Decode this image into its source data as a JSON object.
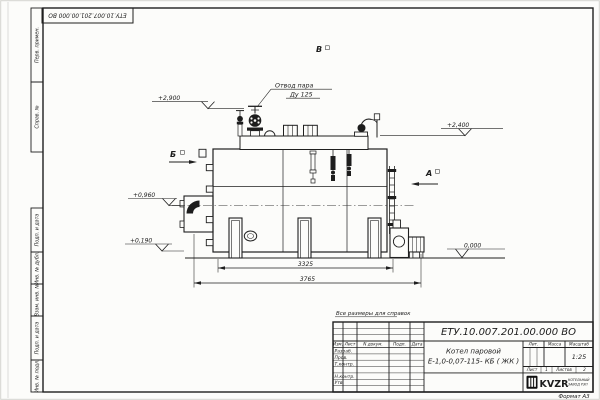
{
  "sheet": {
    "doc_number_top": "ЕТУ.10.007.201.00.000 ВО",
    "format_label": "Формат А3",
    "side_labels_top": [
      "Перв. примен.",
      "Справ. №"
    ],
    "side_labels_bottom": [
      "Подп. и дата",
      "Инв. № дубл.",
      "Взам. инв. №",
      "Подп. и дата",
      "Инв. № подл."
    ]
  },
  "drawing": {
    "note": "Все размеры для справок",
    "steam_outlet": {
      "line1": "Отвод пара",
      "line2": "Ду 125"
    },
    "views": {
      "top": "В",
      "left": "Б",
      "right": "А"
    },
    "elevations": {
      "valve_top": "+2,900",
      "shell_top": "+2,400",
      "burner_axis": "+0,960",
      "lower_port": "+0,190",
      "ground": "0,000"
    },
    "dimensions": {
      "between_supports": "3325",
      "overall_length": "3765"
    }
  },
  "title_block": {
    "doc_number": "ЕТУ.10.007.201.00.000 ВО",
    "product_line1": "Котел паровой",
    "product_line2": "Е-1,0-0,07-115- КБ ( ЖК )",
    "columns": {
      "izm": "Изм.",
      "list": "Лист",
      "ndoc": "N докум.",
      "podp": "Подп.",
      "data": "Дата"
    },
    "rows": [
      "Разраб.",
      "Пров.",
      "Т.контр.",
      "Н.контр.",
      "Утв."
    ],
    "lit_label": "Лит.",
    "mass_label": "Масса",
    "scale_label": "Масштаб",
    "scale_value": "1:25",
    "sheet_label": "Лист",
    "sheet_value": "1",
    "sheets_label": "Листов",
    "sheets_value": "2",
    "logo": {
      "name": "KVZR",
      "sub1": "КОТЕЛЬНЫЙ",
      "sub2": "ЗАВОД РЭП"
    }
  }
}
